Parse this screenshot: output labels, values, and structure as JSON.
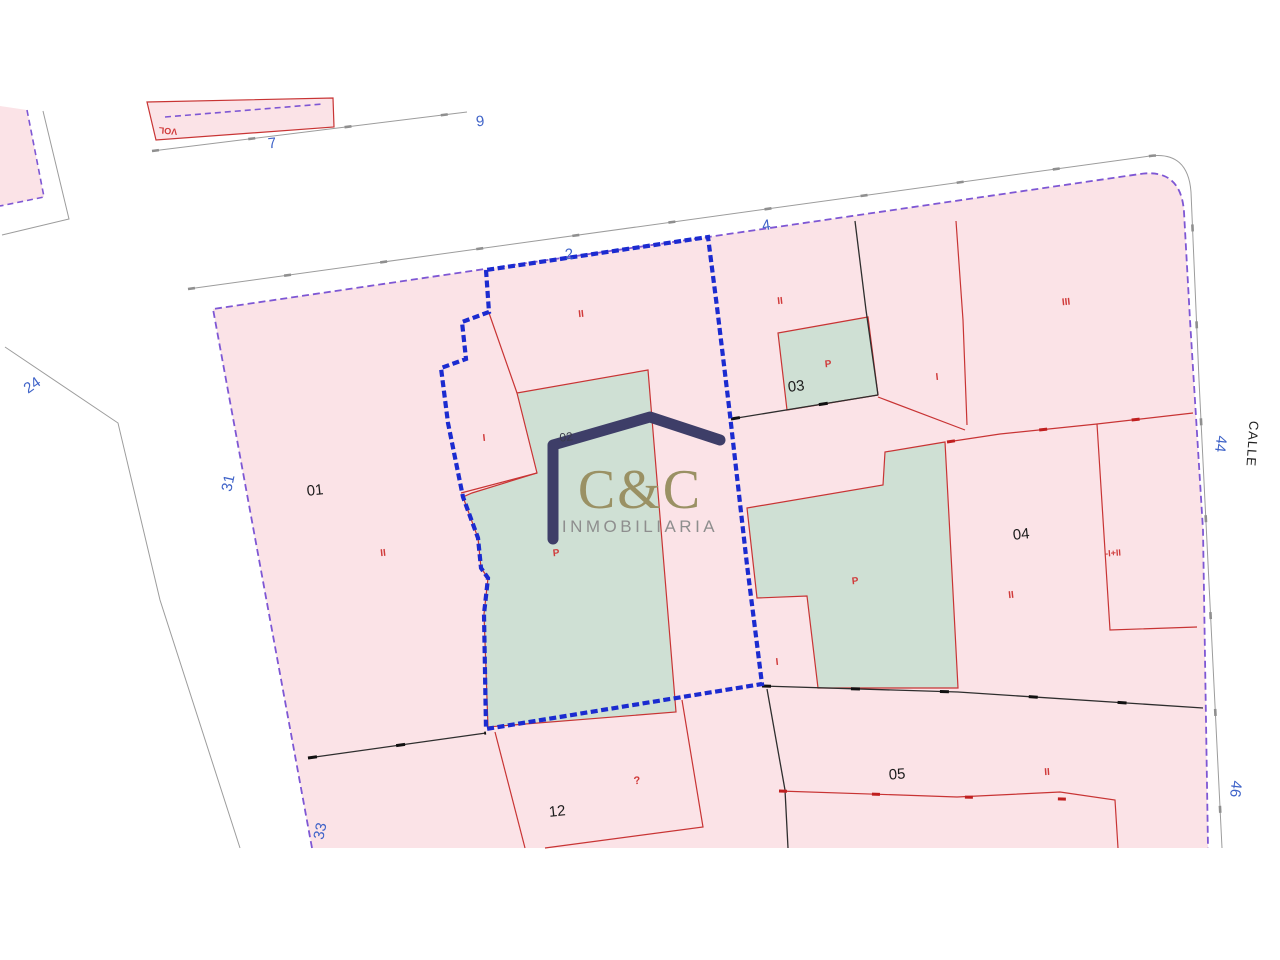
{
  "map": {
    "type": "cadastral-parcel-map",
    "parcel_numbers": [
      "01",
      "02",
      "03",
      "04",
      "05",
      "12"
    ],
    "street_numbers": [
      "9",
      "7",
      "2",
      "4",
      "24",
      "31",
      "33",
      "44",
      "46"
    ],
    "street_name": "CALLE",
    "unit_labels": [
      "II",
      "I",
      "P",
      "II",
      "P",
      "I",
      "III",
      "P",
      "II",
      "-I+II",
      "I",
      "II",
      "?",
      "II",
      "VOL"
    ],
    "colors": {
      "parcel_fill": "#fbe3e7",
      "courtyard_fill": "#cfe0d4",
      "selected_parcel_boundary": "#1b2bd0",
      "block_boundary": "#7e57d4",
      "building_line": "#c83434",
      "parcel_line": "#2e2e2e",
      "street_line": "#9c9c9c",
      "street_number_text": "#3f63c8",
      "unit_label_text": "#d03a3a",
      "parcel_number_text": "#1c1c1c"
    },
    "logo": {
      "name": "C&C",
      "subtitle": "INMOBILIARIA",
      "roof_color": "#3e3e68",
      "name_color": "#9a9164",
      "subtitle_color": "#8e8e8e"
    }
  }
}
